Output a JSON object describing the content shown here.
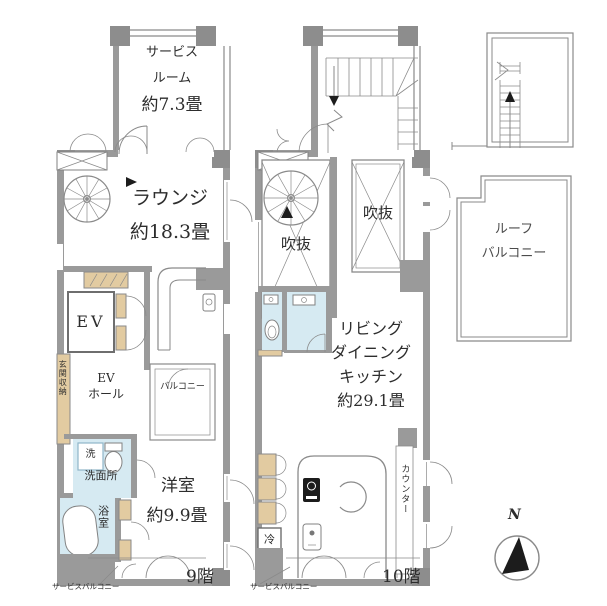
{
  "colors": {
    "wall": "#9a9a9a",
    "column": "#8d8d8d",
    "line": "#8a8a8a",
    "wet": "#d6eaf2",
    "tan": "#e2cba1",
    "text": "#2d2d2d"
  },
  "floor9": {
    "floor_label": "9階",
    "service_room": {
      "line1": "サービス",
      "line2": "ルーム",
      "size": "約7.3畳"
    },
    "lounge": {
      "name": "ラウンジ",
      "size": "約18.3畳"
    },
    "elevator": "EV",
    "ev_hall": {
      "line1": "EV",
      "line2": "ホール"
    },
    "entry_storage": "玄関収納",
    "balcony": "バルコニー",
    "washer": "洗",
    "washroom": "洗面所",
    "bathroom": "浴室",
    "western_room": {
      "name": "洋室",
      "size": "約9.9畳"
    },
    "service_balcony": "サービスバルコニー"
  },
  "floor10": {
    "floor_label": "10階",
    "void_left": "吹抜",
    "void_right": "吹抜",
    "ldk": {
      "line1": "リビング",
      "line2": "ダイニング",
      "line3": "キッチン",
      "size": "約29.1畳"
    },
    "fridge": "冷",
    "counter": "カウンター",
    "service_balcony": "サービスバルコニー"
  },
  "roof": {
    "line1": "ルーフ",
    "line2": "バルコニー"
  },
  "compass": {
    "north": "N"
  }
}
